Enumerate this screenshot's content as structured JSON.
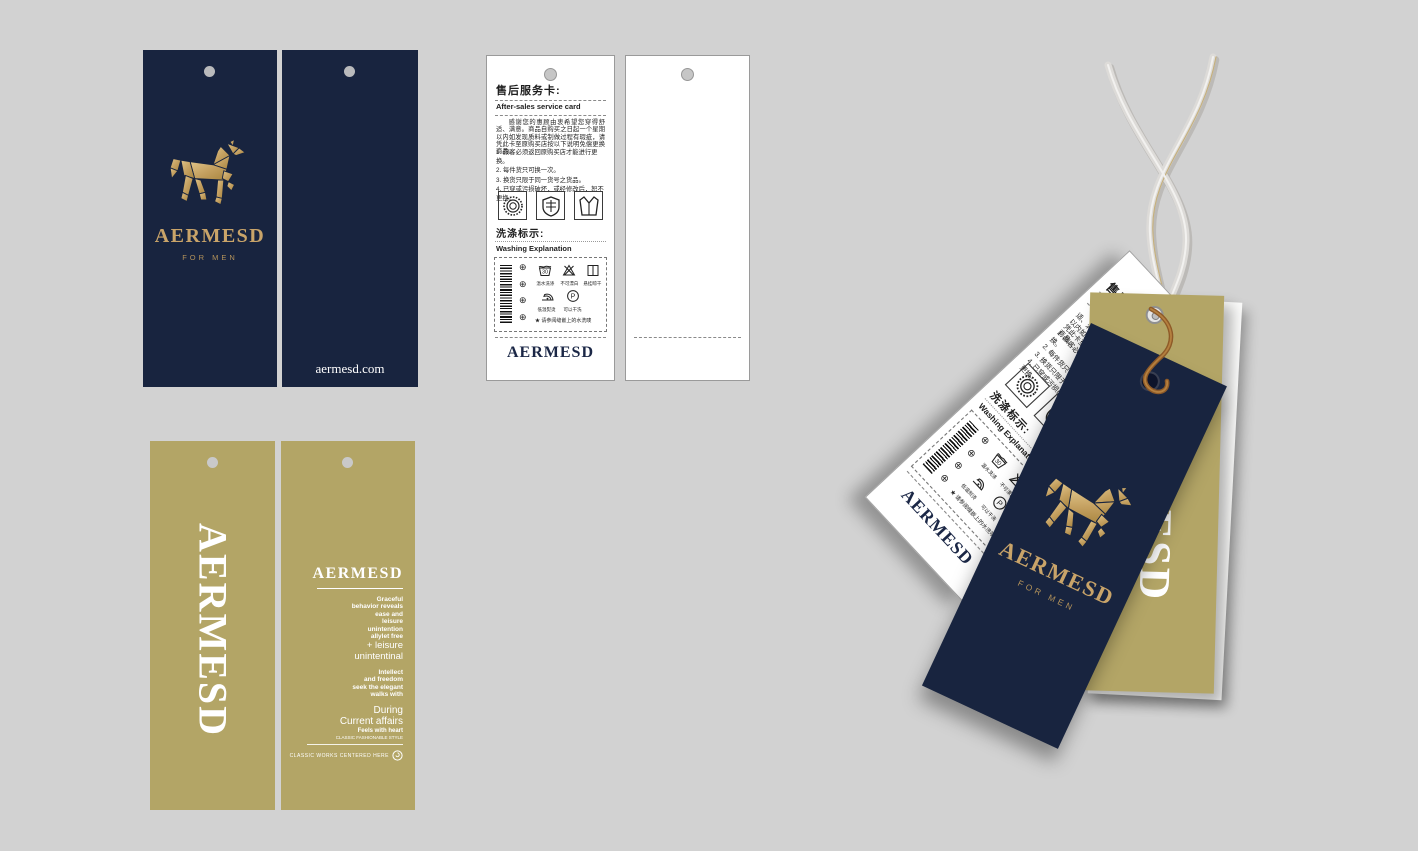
{
  "background_color": "#d2d2d2",
  "colors": {
    "navy": "#18243f",
    "gold_tag": "#b3a566",
    "gold_logo": "#c9a469",
    "white": "#ffffff",
    "twine_brown": "#8e5a28",
    "cord_gray": "#dddbd8"
  },
  "brand": {
    "logo_icon": "origami-horse",
    "logo_text": "AERMESD",
    "tagline": "FOR MEN",
    "website": "aermesd.com"
  },
  "service_card": {
    "title_zh": "售后服务卡:",
    "title_en": "After-sales service card",
    "intro": "感谢您的惠顾由衷希望您穿得舒适、满意。商品自购买之日起一个星期以内如发现质料或制做过程有瑕疵，请凭此卡至原购买店按以下说明免偿更换商品。",
    "rules": "1. 顾客必须返回原购买店才能进行更换。\n2. 每件货只可换一次。\n3. 换货只限于同一货号之货品。\n4. 已穿或污损破坏，或经修改后，恕不更换。",
    "badges": [
      "laurel-badge",
      "shield-badge",
      "suit-badge"
    ],
    "washing_title_zh": "洗涤标示:",
    "washing_title_en": "Washing Explanation",
    "wash_temp": "30",
    "dry_clean_letter": "P",
    "cert_mark": "⊕",
    "care_symbols": [
      {
        "icon": "wash-30-icon",
        "label": "温水洗涤"
      },
      {
        "icon": "no-bleach-icon",
        "label": "不可漂白"
      },
      {
        "icon": "hang-dry-icon",
        "label": "悬挂晾干"
      },
      {
        "icon": "iron-low-icon",
        "label": "低温熨烫"
      },
      {
        "icon": "dry-clean-icon",
        "label": "可以干洗"
      }
    ],
    "care_note": "★ 请参阅缝嵌上的水洗唛",
    "footer_brand": "AERMESD"
  },
  "gold_back_card": {
    "heading": "AERMESD",
    "paragraphs": [
      "Graceful\nbehavior reveals\nease and\nleisure\nunintention\nallylet free",
      "+ leisure\nunintentinal",
      "Intellect\nand freedom\nseek the elegant\nwalks with",
      "During\nCurrent affairs",
      "Feels with heart",
      "CLASSIC FASHIONABLE STYLE"
    ],
    "footer_text": "CLASSIC WORKS CENTERED HERE"
  },
  "gold_front_card": {
    "vertical_text": "AERMESD"
  }
}
